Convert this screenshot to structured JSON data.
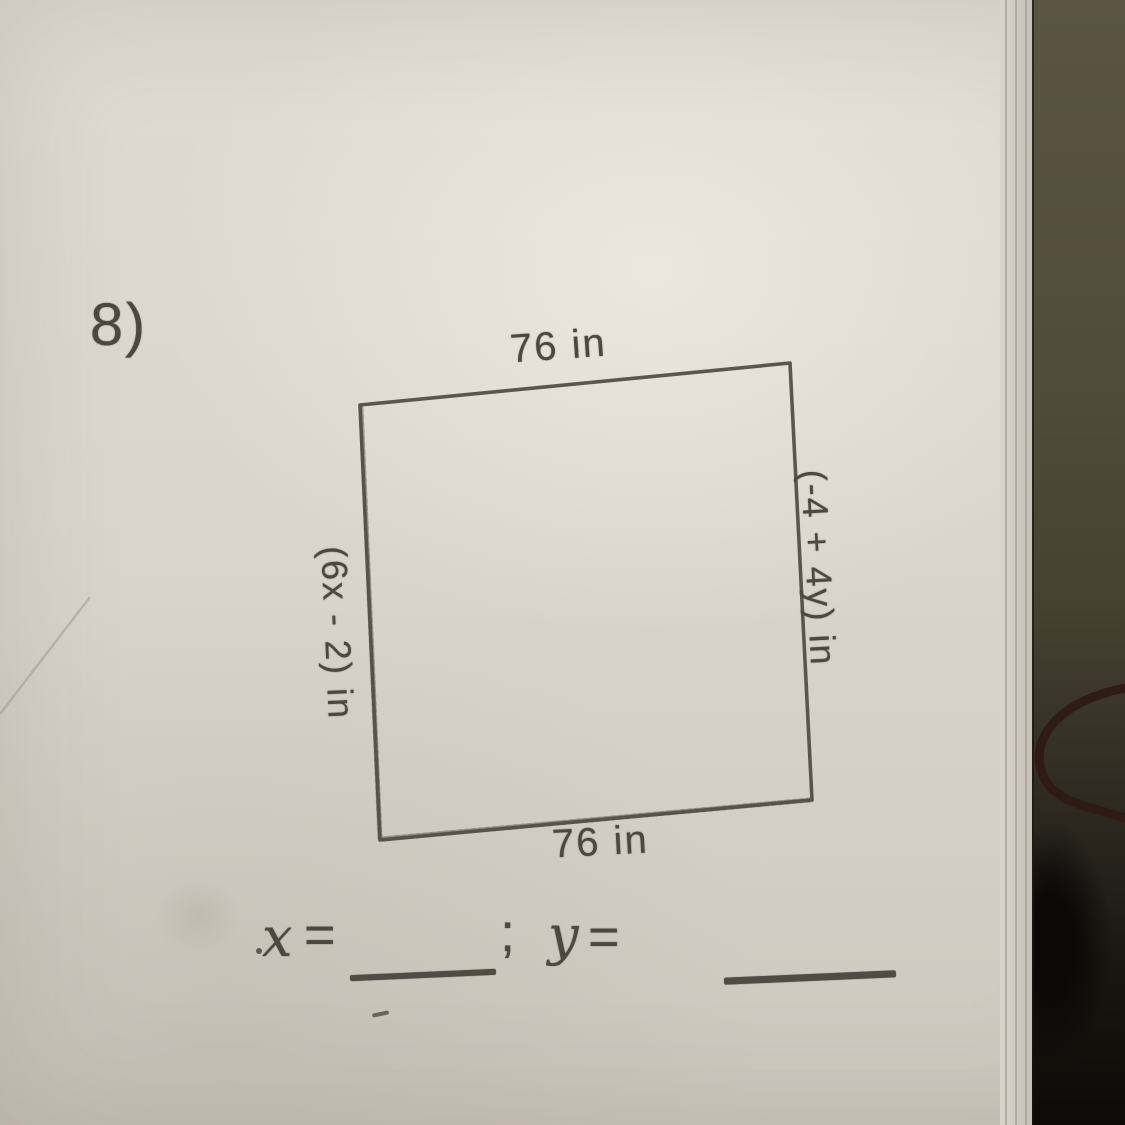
{
  "worksheet": {
    "problem_number": "8)",
    "figure": {
      "type": "quadrilateral",
      "top_side_label": "76 in",
      "bottom_side_label": "76 in",
      "left_side_label": "(6x - 2) in",
      "right_side_label": "(-4 + 4y) in",
      "polygon_points": "360,405 790,363 812,800 380,840"
    },
    "answer_line": {
      "x_label": "x",
      "x_equals": "=",
      "separator": ";",
      "y_label": "y",
      "y_equals": "="
    }
  },
  "colors": {
    "pencil": "#4c4740",
    "paper": "#d8d3cb",
    "table_dark": "#211d15",
    "cable": "#2f1a12"
  },
  "decor": {
    "cable_path": "M 1125,688 C 1062,700 1031,736 1041,770 C 1051,804 1090,806 1125,818",
    "crease_path": "M 0,714 L 90,597",
    "rough_edge_path": "M 361,408 L 380,838 M 381,839 L 810,800"
  }
}
